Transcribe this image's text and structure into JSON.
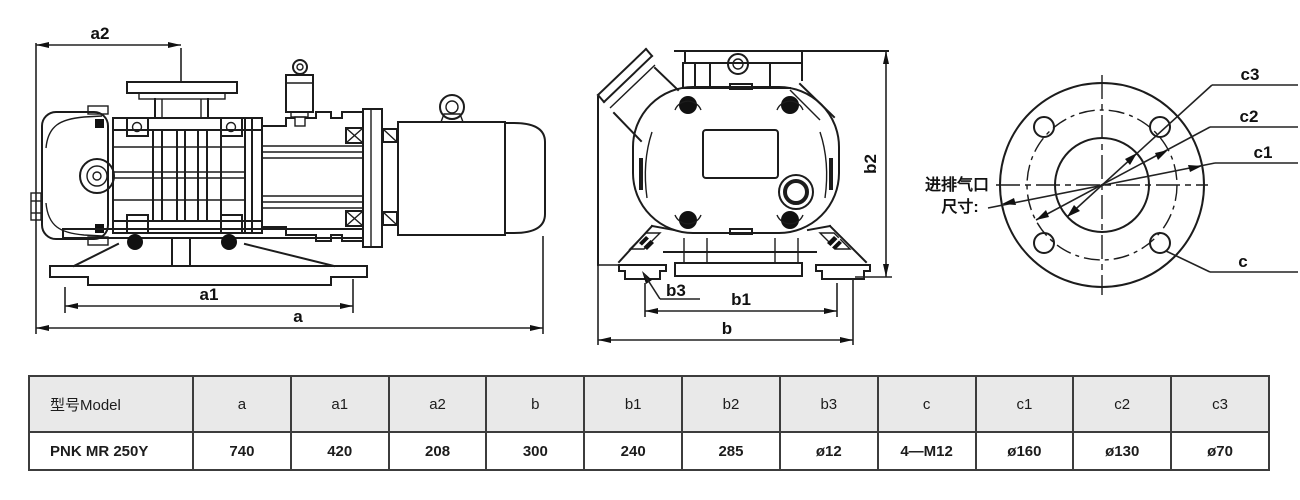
{
  "drawing": {
    "side_view": {
      "dim_a": "a",
      "dim_a1": "a1",
      "dim_a2": "a2"
    },
    "front_view": {
      "dim_b": "b",
      "dim_b1": "b1",
      "dim_b2": "b2",
      "dim_b3": "b3"
    },
    "flange_view": {
      "dim_c": "c",
      "dim_c1": "c1",
      "dim_c2": "c2",
      "dim_c3": "c3",
      "port_note_line1": "进排气口",
      "port_note_line2": "尺寸:"
    }
  },
  "table": {
    "headers": [
      "型号Model",
      "a",
      "a1",
      "a2",
      "b",
      "b1",
      "b2",
      "b3",
      "c",
      "c1",
      "c2",
      "c3"
    ],
    "rows": [
      [
        "PNK MR 250Y",
        "740",
        "420",
        "208",
        "300",
        "240",
        "285",
        "ø12",
        "4—M12",
        "ø160",
        "ø130",
        "ø70"
      ]
    ]
  },
  "colors": {
    "line": "#1c1c1c",
    "table_border": "#3c3c3c",
    "table_header_bg": "#e9e9e9"
  }
}
